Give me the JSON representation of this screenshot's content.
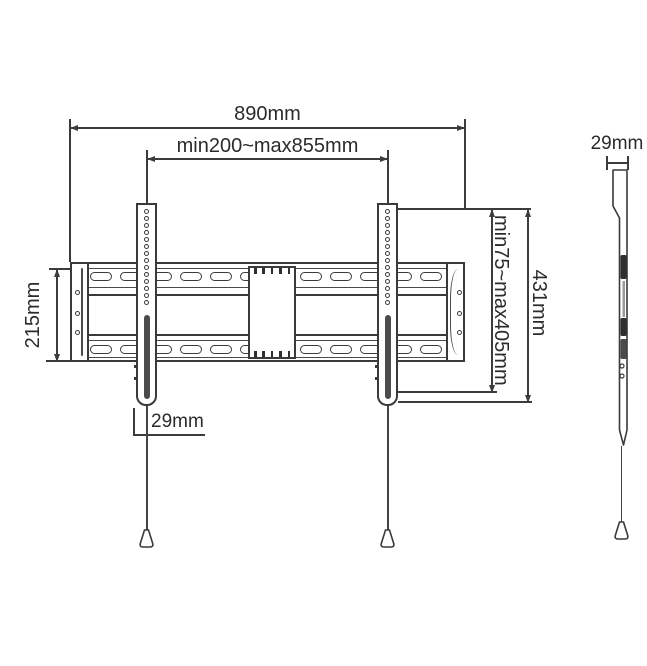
{
  "drawing": {
    "front": {
      "overall_width": "890mm",
      "vesa_width_range": "min200~max855mm",
      "plate_height": "215mm",
      "vesa_height_range": "min75~max405mm",
      "bracket_height": "431mm",
      "bracket_width": "29mm"
    },
    "side": {
      "profile_depth": "29mm"
    },
    "colors": {
      "line": "#3c3c3c",
      "text": "#2b2b2b",
      "slot_fill": "#4b4b4b"
    }
  }
}
